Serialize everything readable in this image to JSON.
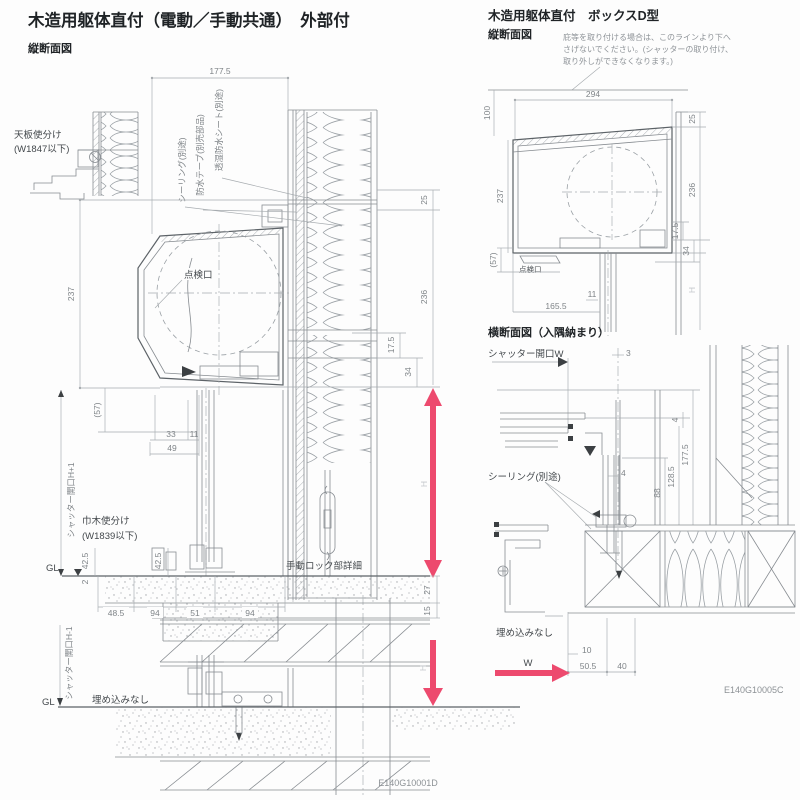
{
  "colors": {
    "accent": "#ed4a6e",
    "line": "#878c91",
    "dim_text": "#7f8488"
  },
  "titles": {
    "main": "木造用躯体直付（電動／手動共通）　外部付",
    "main_view": "縦断面図",
    "box": "木造用躯体直付　ボックスD型",
    "box_view": "縦断面図",
    "cross": "横断面図（入隅納まり）"
  },
  "codes": {
    "main": "E140G10001D",
    "cross": "E140G10005C"
  },
  "note": {
    "line1": "庇等を取り付ける場合は、このラインより下へ",
    "line2": "さげないでください。(シャッターの取り付け、",
    "line3": "取り外しができなくなります。)"
  },
  "main": {
    "labels": {
      "tenban1": "天板使分け",
      "tenban2": "(W1847以下)",
      "sealing": "シーリング(別途)",
      "tape": "防水テープ(別売部品)",
      "sheet": "透湿防水シート(別途)",
      "tenken": "点検口",
      "open_h": "シャッター開口H+1",
      "habaki1": "巾木使分け",
      "habaki2": "(W1839以下)",
      "gl": "GL",
      "lock": "手動ロック部詳細",
      "h": "H"
    },
    "dims": {
      "w177": "177.5",
      "d237": "237",
      "d25": "25",
      "d236": "236",
      "d175": "17.5",
      "d34": "34",
      "d57": "(57)",
      "d33": "33",
      "d11": "11",
      "d49": "49",
      "d425a": "42.5",
      "d425b": "42.5",
      "d2": "2",
      "d485": "48.5",
      "d94a": "94",
      "d51": "51",
      "d94b": "94",
      "d27": "27",
      "d15": "15"
    }
  },
  "bottom": {
    "labels": {
      "open_h": "シャッター開口H-1",
      "gl": "GL",
      "umekomi": "埋め込みなし",
      "h": "H"
    }
  },
  "boxd": {
    "labels": {
      "tenken": "点検口",
      "h": "H"
    },
    "dims": {
      "d100": "100",
      "d294": "294",
      "d25": "25",
      "d237": "237",
      "d236": "236",
      "d175": "17.5",
      "d34": "34",
      "d57": "(57)",
      "d11": "11",
      "d1655": "165.5"
    }
  },
  "cross": {
    "labels": {
      "open_w": "シャッター開口W",
      "sealing": "シーリング(別途)",
      "umekomi": "埋め込みなし",
      "w": "W"
    },
    "dims": {
      "d3": "3",
      "d4a": "4",
      "d1775": "177.5",
      "d1285": "128.5",
      "d88": "88",
      "d4b": "4",
      "d10": "10",
      "d505": "50.5",
      "d40": "40"
    }
  }
}
